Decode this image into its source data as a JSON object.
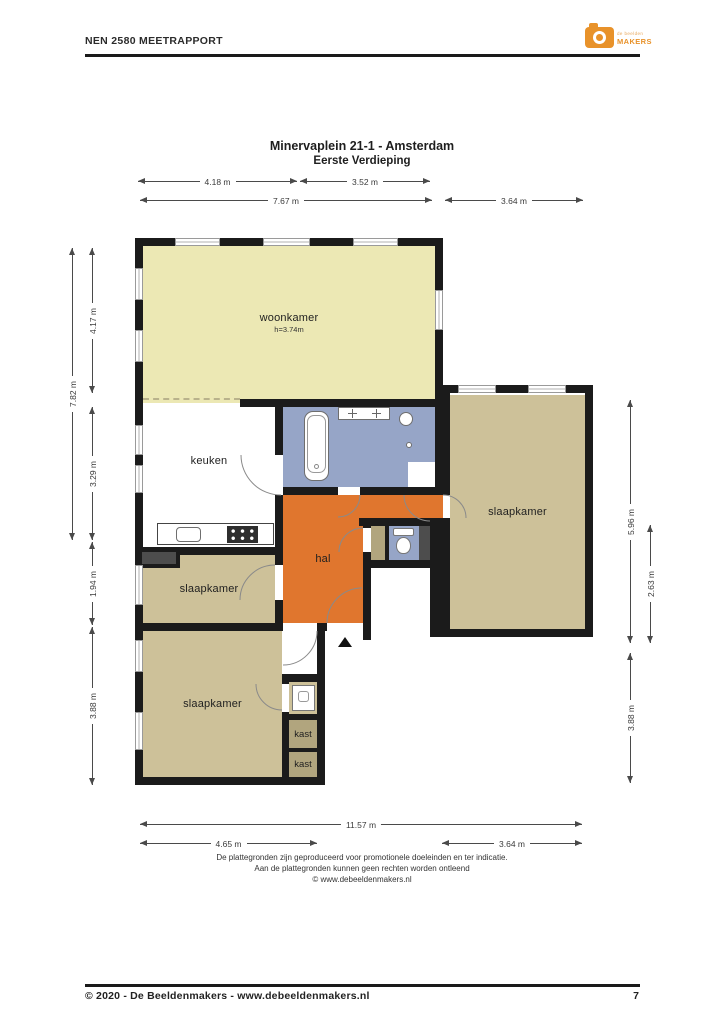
{
  "header": {
    "title": "NEN 2580 MEETRAPPORT",
    "logo_top": "de beelden",
    "logo_bottom": "MAKERS"
  },
  "plan": {
    "title1": "Minervaplein 21-1 - Amsterdam",
    "title2": "Eerste Verdieping",
    "rooms": {
      "woonkamer": "woonkamer",
      "woonkamer_h": "h=3.74m",
      "keuken": "keuken",
      "hal": "hal",
      "slaapkamer_right": "slaapkamer",
      "slaapkamer_mid": "slaapkamer",
      "slaapkamer_bottom": "slaapkamer",
      "kast1": "kast",
      "kast2": "kast"
    },
    "dims": {
      "top1a": "4.18 m",
      "top1b": "3.52 m",
      "top2a": "7.67 m",
      "top2b": "3.64 m",
      "left_outer": "7.82 m",
      "left1": "4.17 m",
      "left2": "3.29 m",
      "left3": "1.94 m",
      "left4": "3.88 m",
      "right1": "5.96 m",
      "right2": "2.63 m",
      "right3": "3.88 m",
      "bottom1": "11.57 m",
      "bottom2a": "4.65 m",
      "bottom2b": "3.64 m"
    },
    "disclaimer": {
      "line1": "De plattegronden zijn geproduceerd voor promotionele doeleinden en ter indicatie.",
      "line2": "Aan de plattegronden kunnen geen rechten worden ontleend",
      "line3": "© www.debeeldenmakers.nl"
    },
    "colors": {
      "wall": "#1b1b1b",
      "woonkamer": "#ece8b4",
      "slaapkamer": "#cdc199",
      "kast": "#b1a57e",
      "hal": "#e0762e",
      "badkamer": "#96a5c7",
      "logo_orange": "#e8922a"
    }
  },
  "footer": {
    "left": "© 2020 - De Beeldenmakers - www.debeeldenmakers.nl",
    "page": "7"
  }
}
